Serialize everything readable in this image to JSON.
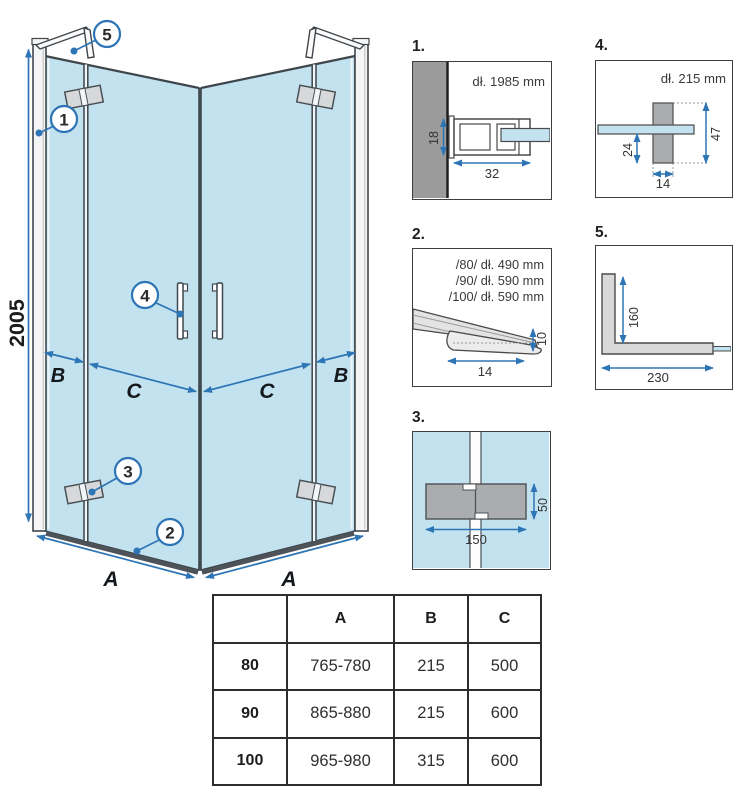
{
  "diagram": {
    "height_label": "2005",
    "labels": {
      "b_left": "B",
      "c_left": "C",
      "c_right": "C",
      "b_right": "B",
      "a_left": "A",
      "a_right": "A"
    },
    "callouts": {
      "c1": "1",
      "c2": "2",
      "c3": "3",
      "c4": "4",
      "c5": "5"
    }
  },
  "details": {
    "d1": {
      "num": "1.",
      "title": "dł. 1985 mm",
      "dim_height": "18",
      "dim_width": "32"
    },
    "d2": {
      "num": "2.",
      "line1": "/80/ dł. 490 mm",
      "line2": "/90/ dł. 590 mm",
      "line3": "/100/ dł. 590 mm",
      "dim_width": "14",
      "dim_height": "10"
    },
    "d3": {
      "num": "3.",
      "dim_width": "150",
      "dim_height": "50"
    },
    "d4": {
      "num": "4.",
      "title": "dł. 215 mm",
      "dim_offset": "24",
      "dim_height": "47",
      "dim_width": "14"
    },
    "d5": {
      "num": "5.",
      "dim_height": "160",
      "dim_width": "230"
    }
  },
  "table": {
    "headers": [
      "",
      "A",
      "B",
      "C"
    ],
    "rows": [
      {
        "size": "80",
        "a": "765-780",
        "b": "215",
        "c": "500"
      },
      {
        "size": "90",
        "a": "865-880",
        "b": "215",
        "c": "600"
      },
      {
        "size": "100",
        "a": "965-980",
        "b": "315",
        "c": "600"
      }
    ]
  },
  "colors": {
    "glass_blue": "#c3e2ef",
    "dimension_blue": "#2e75b6",
    "outline_dark": "#3f464c",
    "hardware_gray": "#aaacae",
    "wall_gray": "#9b9b9b"
  }
}
